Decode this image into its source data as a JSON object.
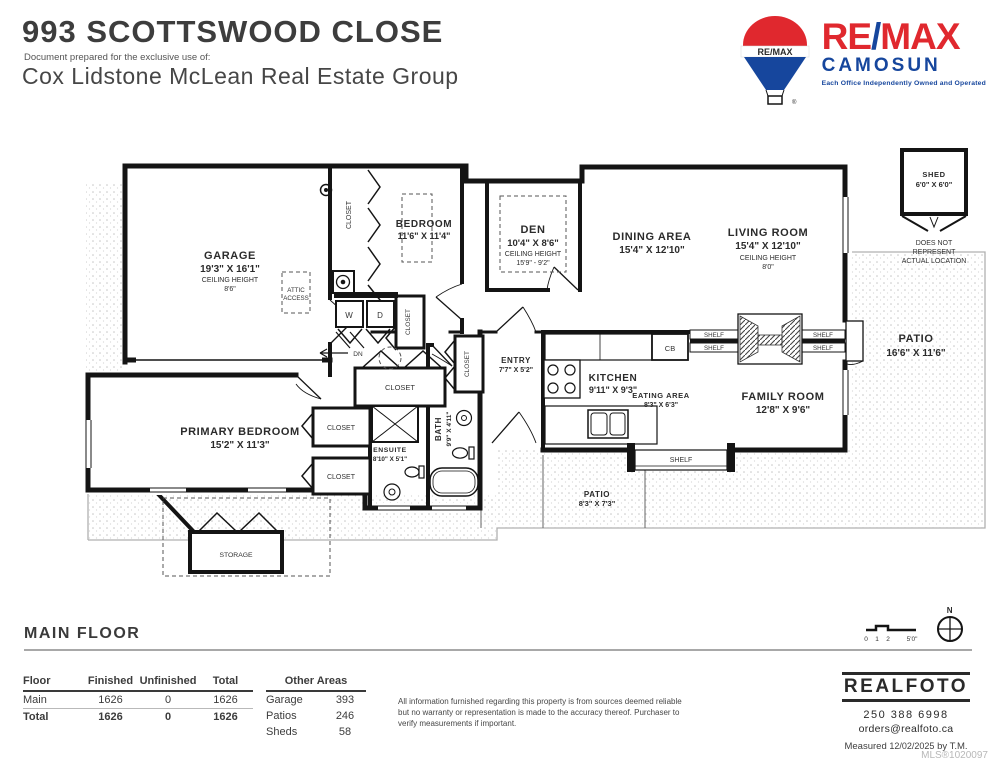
{
  "header": {
    "address": "993 SCOTTSWOOD CLOSE",
    "prepared_for": "Document prepared for the exclusive use of:",
    "client": "Cox Lidstone McLean Real Estate Group"
  },
  "remax": {
    "wordmark_re": "RE",
    "wordmark_slash": "/",
    "wordmark_max": "MAX",
    "balloon_text": "RE/MAX",
    "office": "CAMOSUN",
    "tagline": "Each Office Independently Owned and Operated",
    "registered": "®"
  },
  "colors": {
    "remax_red": "#e0282e",
    "remax_blue": "#16469d",
    "remax_dark_blue": "#0d3472"
  },
  "plan": {
    "floor_title": "MAIN FLOOR",
    "north": "N",
    "scale": {
      "t0": "0",
      "t1": "1",
      "t2": "2",
      "t5": "5'0\""
    },
    "rooms": {
      "ceiling_label": "CEILING HEIGHT",
      "garage": {
        "name": "GARAGE",
        "dims": "19'3\" X 16'1\"",
        "ceiling": "8'6\""
      },
      "bedroom": {
        "name": "BEDROOM",
        "dims": "11'6\" X 11'4\""
      },
      "den": {
        "name": "DEN",
        "dims": "10'4\" X 8'6\"",
        "ceiling": "15'9\" - 9'2\""
      },
      "dining": {
        "name": "DINING AREA",
        "dims": "15'4\" X 12'10\""
      },
      "living": {
        "name": "LIVING ROOM",
        "dims": "15'4\" X 12'10\"",
        "ceiling": "8'0\""
      },
      "shed": {
        "name": "SHED",
        "dims": "6'0\" X 6'0\"",
        "note_line1": "DOES NOT",
        "note_line2": "REPRESENT",
        "note_line3": "ACTUAL LOCATION"
      },
      "patio_main": {
        "name": "PATIO",
        "dims": "16'6\" X 11'6\""
      },
      "kitchen": {
        "name": "KITCHEN",
        "dims": "9'11\" X 9'3\""
      },
      "eating": {
        "name": "EATING AREA",
        "dims": "8'3\" X 6'3\""
      },
      "family": {
        "name": "FAMILY ROOM",
        "dims": "12'8\" X 9'6\""
      },
      "primary": {
        "name": "PRIMARY BEDROOM",
        "dims": "15'2\" X 11'3\""
      },
      "ensuite": {
        "name": "ENSUITE",
        "dims": "8'10\" X 5'1\""
      },
      "bath": {
        "name": "BATH",
        "dims": "9'9\" X 4'11\""
      },
      "entry": {
        "name": "ENTRY",
        "dims": "7'7\" X 5'2\""
      },
      "patio_small": {
        "name": "PATIO",
        "dims": "8'3\" X 7'3\""
      },
      "storage": "STORAGE",
      "attic_line1": "ATTIC",
      "attic_line2": "ACCESS",
      "closet": "CLOSET",
      "shelf": "SHELF",
      "cb": "CB",
      "dn": "DN",
      "washer": "W",
      "dryer": "D"
    }
  },
  "area_table": {
    "headers": {
      "floor": "Floor",
      "finished": "Finished",
      "unfinished": "Unfinished",
      "total": "Total"
    },
    "rows": [
      {
        "floor": "Main",
        "finished": "1626",
        "unfinished": "0",
        "total": "1626"
      },
      {
        "floor": "Total",
        "finished": "1626",
        "unfinished": "0",
        "total": "1626"
      }
    ],
    "other": {
      "title": "Other Areas",
      "rows": [
        {
          "label": "Garage",
          "value": "393"
        },
        {
          "label": "Patios",
          "value": "246"
        },
        {
          "label": "Sheds",
          "value": "58"
        }
      ]
    }
  },
  "disclaimer": "All information furnished regarding this property is from sources deemed reliable but no warranty or representation is made to the accuracy thereof. Purchaser to verify measurements if important.",
  "realfoto": {
    "logo": "REALFOTO",
    "phone": "250 388 6998",
    "email": "orders@realfoto.ca",
    "measured_label": "Measured",
    "measured_date": "12/02/2025",
    "measured_by": "by T.M.",
    "mls": "MLS®1020097"
  }
}
